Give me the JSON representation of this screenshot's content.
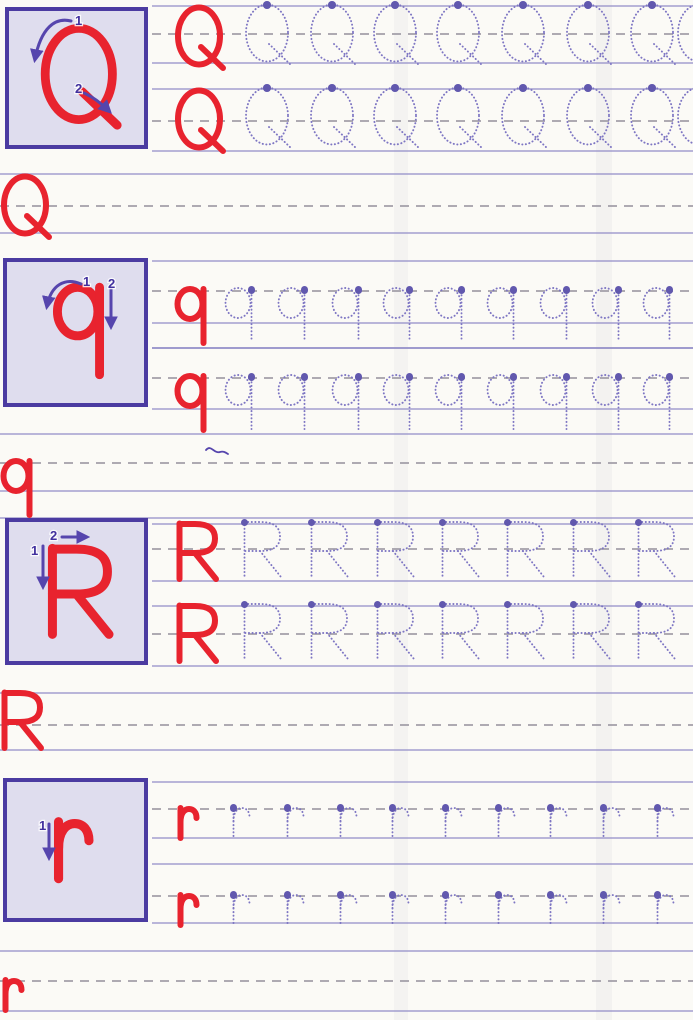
{
  "worksheet": {
    "type": "handwriting tracing practice page",
    "letters_practiced": [
      "Q",
      "q",
      "R",
      "r"
    ]
  },
  "colors": {
    "page_bg": "#fbfaf6",
    "example_red": "#e8232e",
    "trace_purple": "#7e76c3",
    "start_dot_purple": "#6158ae",
    "rule_solid": "#8f8ac6",
    "rule_dashed": "#98949f",
    "box_fill": "#dfddee",
    "box_border": "#4b3ba1",
    "arrow_purple": "#5645ad",
    "step_number": "#41309e"
  },
  "sections": [
    {
      "letter": "Q",
      "letter_case": "uppercase",
      "guide_box": {
        "x": 5,
        "y": 7,
        "w": 143,
        "h": 142,
        "glyph": {
          "x": 37,
          "y": 19,
          "s": 1.6,
          "sw": 5.5
        },
        "steps": [
          {
            "label": "1",
            "tx": 70,
            "ty": 7,
            "path": "M66 14 C50 10 36 21 30 52"
          },
          {
            "label": "2",
            "tx": 70,
            "ty": 75,
            "path": "M79 86 C88 90 97 97 104 104"
          }
        ]
      },
      "rows": [
        {
          "lines": {
            "x0": 152,
            "top": 5,
            "mid": 33,
            "base": 62
          },
          "example": {
            "x": 176,
            "y": 6
          },
          "traces": {
            "y": 3,
            "s": 1,
            "xs": [
              244,
              309,
              372,
              435,
              500,
              565,
              629,
              676
            ]
          }
        },
        {
          "lines": {
            "x0": 152,
            "top": 88,
            "mid": 120,
            "base": 150
          },
          "example": {
            "x": 176,
            "y": 89
          },
          "traces": {
            "y": 86,
            "s": 1,
            "xs": [
              244,
              309,
              372,
              435,
              500,
              565,
              629,
              676
            ]
          }
        }
      ],
      "write_line": {
        "x0": 0,
        "top": 173,
        "mid": 205,
        "base": 232,
        "example": {
          "x": 2,
          "y": 175
        }
      }
    },
    {
      "letter": "q",
      "letter_case": "lowercase",
      "guide_box": {
        "x": 3,
        "y": 258,
        "w": 145,
        "h": 149,
        "glyph": {
          "x": 52,
          "y": 26,
          "s": 1.62,
          "sw": 5.5
        },
        "steps": [
          {
            "label": "1",
            "tx": 80,
            "ty": 17,
            "path": "M78 26 C62 19 48 27 44 48"
          },
          {
            "label": "2",
            "tx": 105,
            "ty": 19,
            "path": "M108 30 L108 68"
          }
        ]
      },
      "rows": [
        {
          "lines": {
            "x0": 152,
            "top": 260,
            "mid": 290,
            "base": 322,
            "desc": 347
          },
          "example": {
            "x": 176,
            "y": 287
          },
          "traces": {
            "y": 286,
            "s": 1,
            "xs": [
              224,
              277,
              331,
              382,
              434,
              486,
              539,
              591,
              642
            ]
          }
        },
        {
          "lines": {
            "x0": 152,
            "top": 347,
            "mid": 377,
            "base": 408
          },
          "example": {
            "x": 176,
            "y": 374
          },
          "traces": {
            "y": 373,
            "s": 1,
            "xs": [
              224,
              277,
              331,
              382,
              434,
              486,
              539,
              591,
              642
            ]
          }
        }
      ],
      "write_line": {
        "x0": 0,
        "top": 433,
        "mid": 462,
        "base": 490,
        "desc": 517,
        "example": {
          "x": 2,
          "y": 459
        }
      }
    },
    {
      "letter": "R",
      "letter_case": "uppercase",
      "guide_box": {
        "x": 5,
        "y": 518,
        "w": 143,
        "h": 147,
        "glyph": {
          "x": 42,
          "y": 28,
          "s": 1.55,
          "sw": 5.8
        },
        "steps": [
          {
            "label": "1",
            "tx": 26,
            "ty": 26,
            "path": "M38 28 L38 68"
          },
          {
            "label": "2",
            "tx": 45,
            "ty": 11,
            "path": "M57 19 L81 19"
          }
        ]
      },
      "rows": [
        {
          "lines": {
            "x0": 152,
            "top": 523,
            "mid": 548,
            "base": 580
          },
          "example": {
            "x": 176,
            "y": 522
          },
          "traces": {
            "y": 520,
            "s": 1,
            "xs": [
              241,
              308,
              374,
              439,
              504,
              570,
              635
            ]
          }
        },
        {
          "lines": {
            "x0": 152,
            "top": 605,
            "mid": 633,
            "base": 665
          },
          "example": {
            "x": 176,
            "y": 604
          },
          "traces": {
            "y": 602,
            "s": 1,
            "xs": [
              241,
              308,
              374,
              439,
              504,
              570,
              635
            ]
          }
        }
      ],
      "write_line": {
        "x0": 0,
        "top": 692,
        "mid": 724,
        "base": 749,
        "example": {
          "x": 1,
          "y": 691
        }
      }
    },
    {
      "letter": "r",
      "letter_case": "lowercase",
      "guide_box": {
        "x": 3,
        "y": 778,
        "w": 145,
        "h": 144,
        "glyph": {
          "x": 47,
          "y": 38,
          "s": 1.9,
          "sw": 4.8
        },
        "steps": [
          {
            "label": "1",
            "tx": 36,
            "ty": 41,
            "path": "M46 46 L46 79"
          }
        ]
      },
      "rows": [
        {
          "lines": {
            "x0": 152,
            "top": 781,
            "mid": 808,
            "base": 837
          },
          "example": {
            "x": 176,
            "y": 805
          },
          "traces": {
            "y": 804,
            "s": 1,
            "xs": [
              229,
              283,
              336,
              388,
              441,
              494,
              546,
              599,
              653
            ]
          }
        },
        {
          "lines": {
            "x0": 152,
            "top": 863,
            "mid": 895,
            "base": 922
          },
          "example": {
            "x": 176,
            "y": 892
          },
          "traces": {
            "y": 891,
            "s": 1,
            "xs": [
              229,
              283,
              336,
              388,
              441,
              494,
              546,
              599,
              653
            ]
          }
        }
      ],
      "write_line": {
        "x0": 0,
        "top": 950,
        "mid": 980,
        "base": 1010,
        "example": {
          "x": 1,
          "y": 977
        }
      }
    }
  ],
  "artifacts": {
    "stray_pen_mark": {
      "x": 203,
      "y": 441
    }
  }
}
